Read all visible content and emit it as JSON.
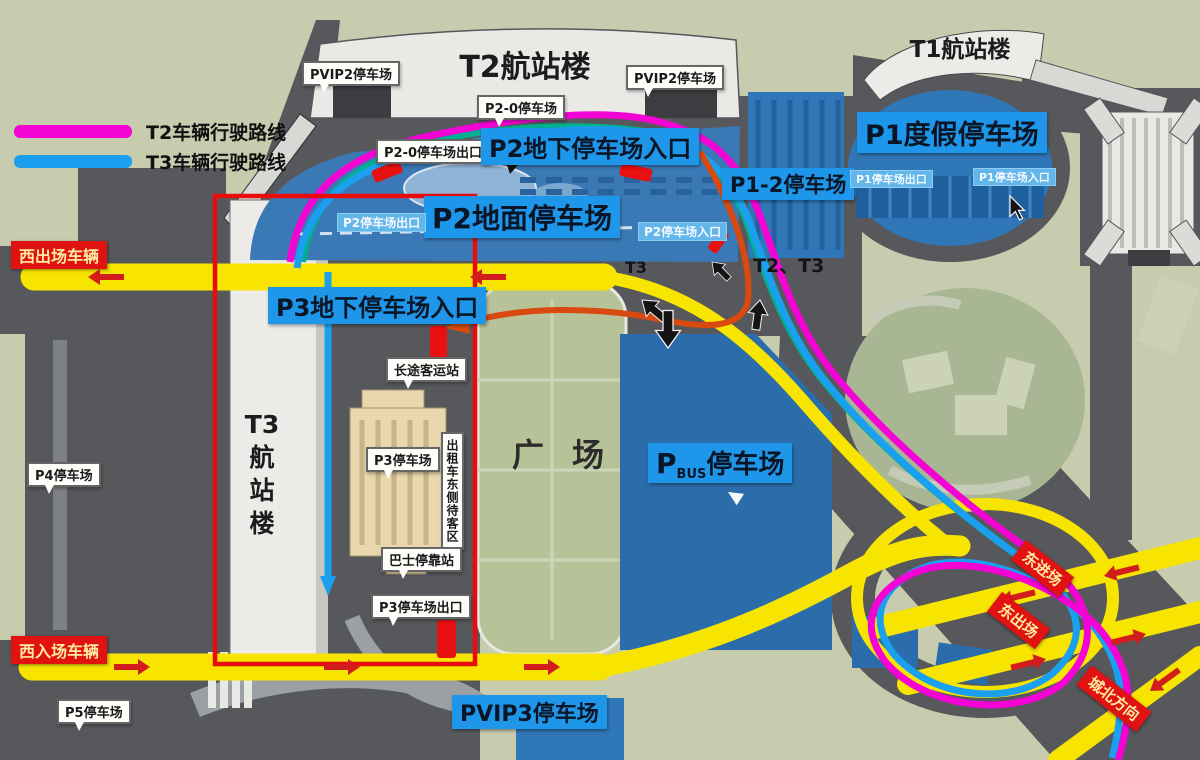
{
  "legend": {
    "items": [
      {
        "label": "T2车辆行驶路线",
        "color": "#f303d4"
      },
      {
        "label": "T3车辆行驶路线",
        "color": "#1ba0ef"
      }
    ]
  },
  "terminals": {
    "t2": "T2航站楼",
    "t1": "T1航站楼",
    "t3_lines": [
      "T3",
      "航",
      "站",
      "楼"
    ]
  },
  "parking": {
    "pvip2_left": "PVIP2停车场",
    "pvip2_right": "PVIP2停车场",
    "p2_0": "P2-0停车场",
    "p2_0_exit": "P2-0停车场出口",
    "p2_underground_entrance": "P2地下停车场入口",
    "p2_ground": "P2地面停车场",
    "p2_exit": "P2停车场出口",
    "p2_entrance": "P2停车场入口",
    "p1_2": "P1-2停车场",
    "p1_holiday": "P1度假停车场",
    "p1_exit": "P1停车场出口",
    "p1_entrance": "P1停车场入口",
    "p3_underground_entrance": "P3地下停车场入口",
    "p3": "P3停车场",
    "p3_exit": "P3停车场出口",
    "p4": "P4停车场",
    "p5": "P5停车场",
    "pvip3": "PVIP3停车场",
    "pbus_prefix": "P",
    "pbus_sub": "BUS",
    "pbus_suffix": "停车场"
  },
  "facilities": {
    "long_distance_bus": "长途客运站",
    "taxi_east_wait_area": "出租车东侧待客区",
    "bus_stop": "巴士停靠站",
    "plaza": "广场"
  },
  "badges": {
    "west_exit": "西出场车辆",
    "west_entrance": "西入场车辆",
    "east_entrance": "东进场",
    "east_exit": "东出场",
    "north": "城北方向"
  },
  "road_labels": {
    "t2_t3": "T2、T3",
    "t3": "T3"
  },
  "colors": {
    "t2_route": "#f303d4",
    "t3_route": "#1ba0ef",
    "road_yellow": "#f7e400",
    "lot_blue": "#2f77b6",
    "banner_blue": "#1e96ea",
    "highlight_red": "#e80c0c",
    "background_green": "#c7ccae",
    "road_dark": "#56585c"
  }
}
